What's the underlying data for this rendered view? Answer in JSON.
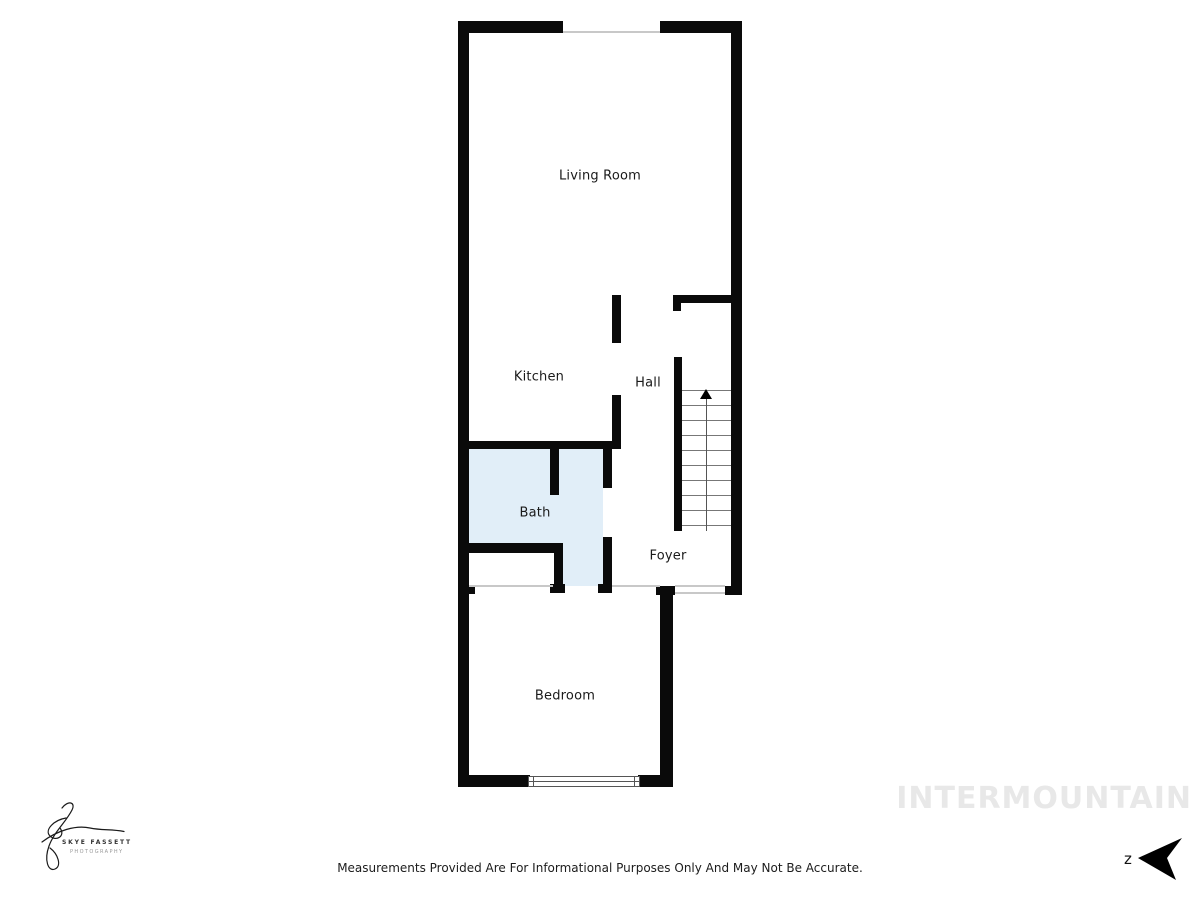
{
  "plan": {
    "rooms": [
      {
        "name": "living-room",
        "label": "Living Room"
      },
      {
        "name": "kitchen",
        "label": "Kitchen"
      },
      {
        "name": "hall",
        "label": "Hall"
      },
      {
        "name": "bath",
        "label": "Bath"
      },
      {
        "name": "foyer",
        "label": "Foyer"
      },
      {
        "name": "bedroom",
        "label": "Bedroom"
      }
    ],
    "colors": {
      "wall": "#0a0a0a",
      "bath_fill": "#e1eef8",
      "opening_line": "#c8c8c8",
      "stair_tread": "#777777",
      "watermark": "#e8e8e8"
    },
    "stairs": {
      "tread_lines": 10,
      "direction_arrow": "up"
    }
  },
  "branding": {
    "logo_title": "SKYE FASSETT",
    "logo_subtitle": "PHOTOGRAPHY",
    "watermark": "INTERMOUNTAIN"
  },
  "compass": {
    "label": "z"
  },
  "footer": {
    "disclaimer": "Measurements Provided Are For Informational Purposes Only And May Not Be Accurate."
  }
}
